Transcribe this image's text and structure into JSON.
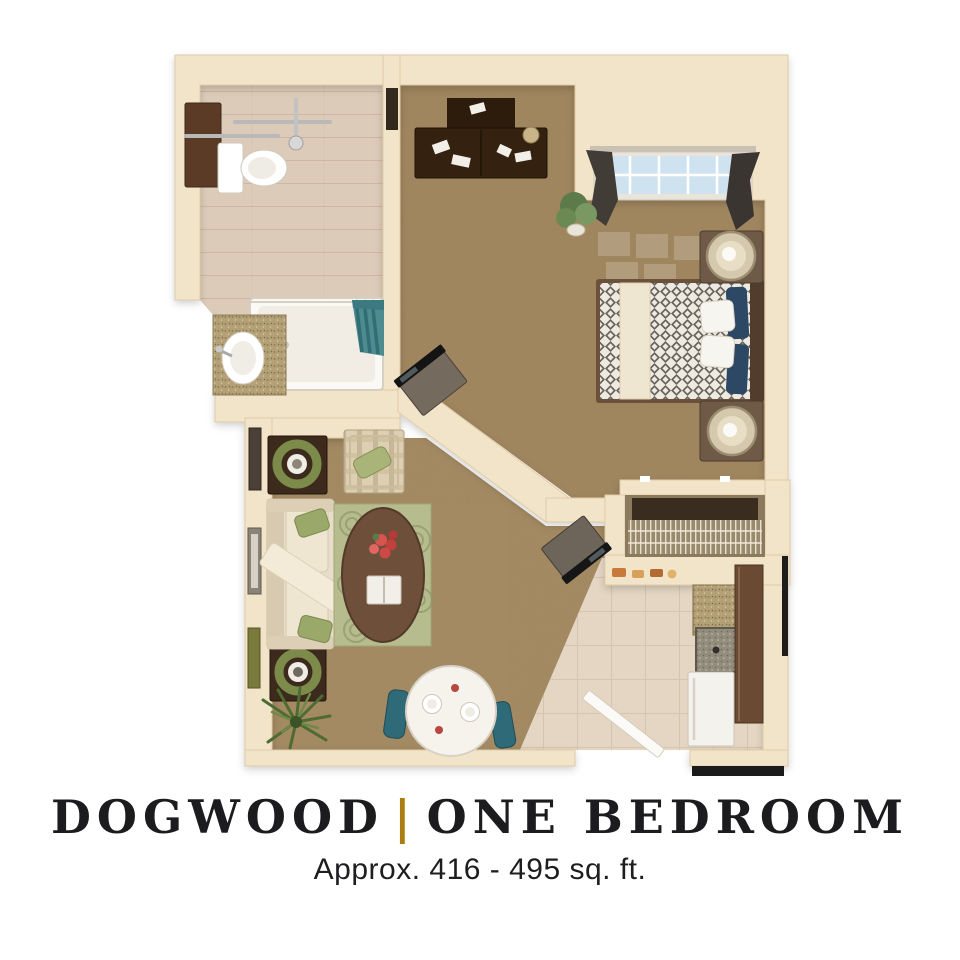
{
  "page": {
    "background_color": "#ffffff"
  },
  "caption": {
    "name": "DOGWOOD",
    "separator": "|",
    "unit_type": "ONE BEDROOM",
    "subtitle": "Approx. 416 - 495 sq. ft.",
    "accent_color": "#ab7d10",
    "title_color": "#1c1c1e"
  },
  "floor_plan": {
    "description": "3D top-down rendering of a one-bedroom apartment floor plan",
    "rooms": [
      {
        "name": "bathroom",
        "furniture": [
          "toilet",
          "wall-cabinet",
          "grab-bars",
          "shower-head",
          "bathtub-shower",
          "shower-curtain",
          "vanity-sink"
        ]
      },
      {
        "name": "bedroom",
        "furniture": [
          "desk-with-papers",
          "window-with-curtains",
          "potted-plant",
          "bed",
          "navy-pillows",
          "white-pillows",
          "nightstand-with-lamp",
          "nightstand-with-lamp",
          "tv-on-stand"
        ]
      },
      {
        "name": "closet",
        "furniture": [
          "wire-shelving",
          "hanging-rod"
        ]
      },
      {
        "name": "kitchen",
        "furniture": [
          "granite-counter",
          "kitchen-sink",
          "tall-cabinet",
          "refrigerator",
          "pass-through-counter-items"
        ]
      },
      {
        "name": "living-room",
        "furniture": [
          "sofa-with-throw",
          "green-accent-pillows",
          "end-table-with-wreath",
          "end-table-with-wreath",
          "striped-armchair",
          "area-rug",
          "oval-coffee-table",
          "flower-centerpiece",
          "book",
          "tv-on-stand",
          "wall-art-frames",
          "floor-plant"
        ]
      },
      {
        "name": "dining-area",
        "furniture": [
          "round-dining-table",
          "place-settings",
          "dining-chair",
          "dining-chair"
        ]
      },
      {
        "name": "entry",
        "furniture": [
          "open-entry-door",
          "door-mat"
        ]
      }
    ],
    "colors": {
      "walls": "#f2e4c8",
      "carpet": "#a1865e",
      "bathroom_tile": "#dccbb8",
      "kitchen_tile": "#e5d6c3",
      "dark_wood": "#3a2415",
      "navy_accent": "#2c4864",
      "teal_accent": "#2e6a78",
      "rug_green": "#b7bc8f"
    }
  }
}
